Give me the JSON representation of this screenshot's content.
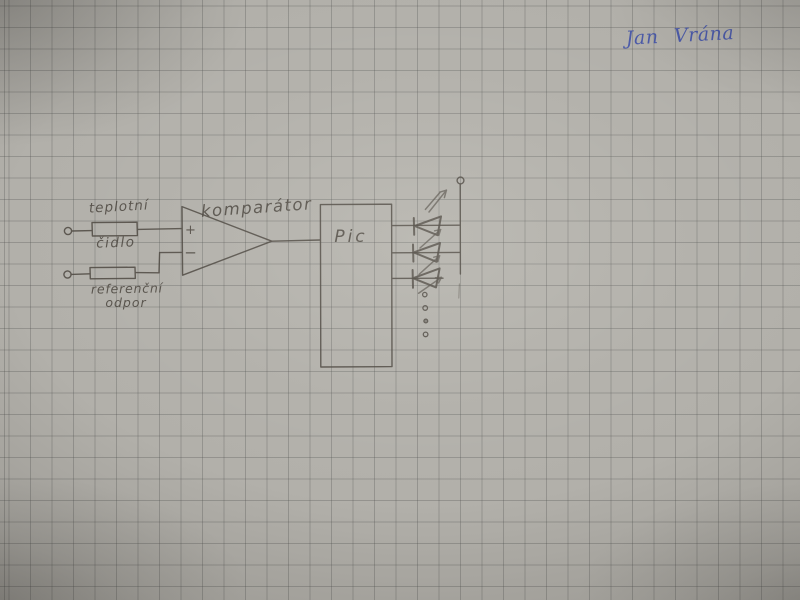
{
  "photo": {
    "paper_color": "#b2b0aa",
    "grid_color": "#8e8c87",
    "pencil_color": "#4b463f"
  },
  "signature": {
    "text": "Jan Vrána",
    "ink_color": "#4353a8"
  },
  "schematic": {
    "labels": {
      "sensor_line1": "teplotní",
      "sensor_line2": "čidlo",
      "reference_line1": "referenční",
      "reference_line2": "odpor",
      "comparator": "komparátor",
      "comparator_plus": "+",
      "comparator_minus": "−",
      "mcu": "Pic"
    },
    "led_count": 3,
    "continuation_dots": 4
  }
}
